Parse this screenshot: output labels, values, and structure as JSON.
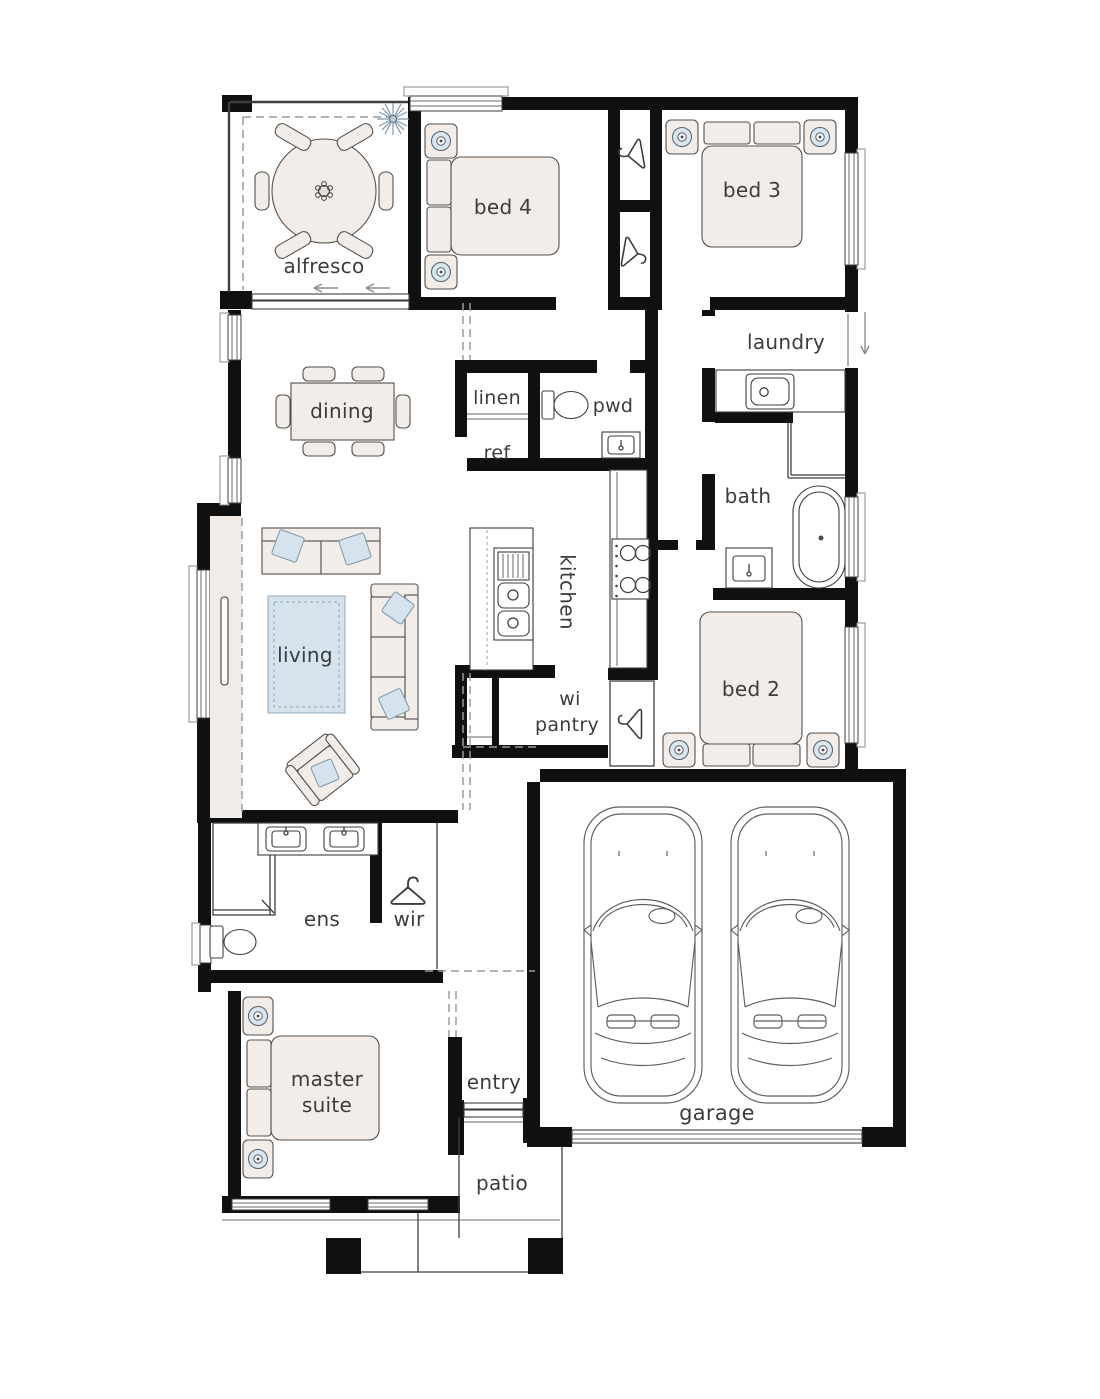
{
  "plan_type": "single-storey house floor plan",
  "colors": {
    "wall": "#101010",
    "furniture_fill": "#f2ede8",
    "accent_blue": "#d5e3ee",
    "label_text": "#3c3c3c",
    "background": "#ffffff"
  },
  "labels": {
    "alfresco": "alfresco",
    "bed4": "bed 4",
    "bed3": "bed 3",
    "laundry": "laundry",
    "dining": "dining",
    "linen": "linen",
    "pwd": "pwd",
    "ref": "ref",
    "bath": "bath",
    "kitchen": "kitchen",
    "wi_pantry_line1": "wi",
    "wi_pantry_line2": "pantry",
    "living": "living",
    "bed2": "bed 2",
    "ens": "ens",
    "wir": "wir",
    "master_line1": "master",
    "master_line2": "suite",
    "entry": "entry",
    "garage": "garage",
    "patio": "patio"
  },
  "rooms": [
    {
      "name": "alfresco"
    },
    {
      "name": "bed 4"
    },
    {
      "name": "bed 3"
    },
    {
      "name": "laundry"
    },
    {
      "name": "dining"
    },
    {
      "name": "linen"
    },
    {
      "name": "pwd"
    },
    {
      "name": "ref"
    },
    {
      "name": "bath"
    },
    {
      "name": "kitchen"
    },
    {
      "name": "wi pantry"
    },
    {
      "name": "living"
    },
    {
      "name": "bed 2"
    },
    {
      "name": "ens"
    },
    {
      "name": "wir"
    },
    {
      "name": "master suite"
    },
    {
      "name": "entry"
    },
    {
      "name": "garage"
    },
    {
      "name": "patio"
    }
  ]
}
